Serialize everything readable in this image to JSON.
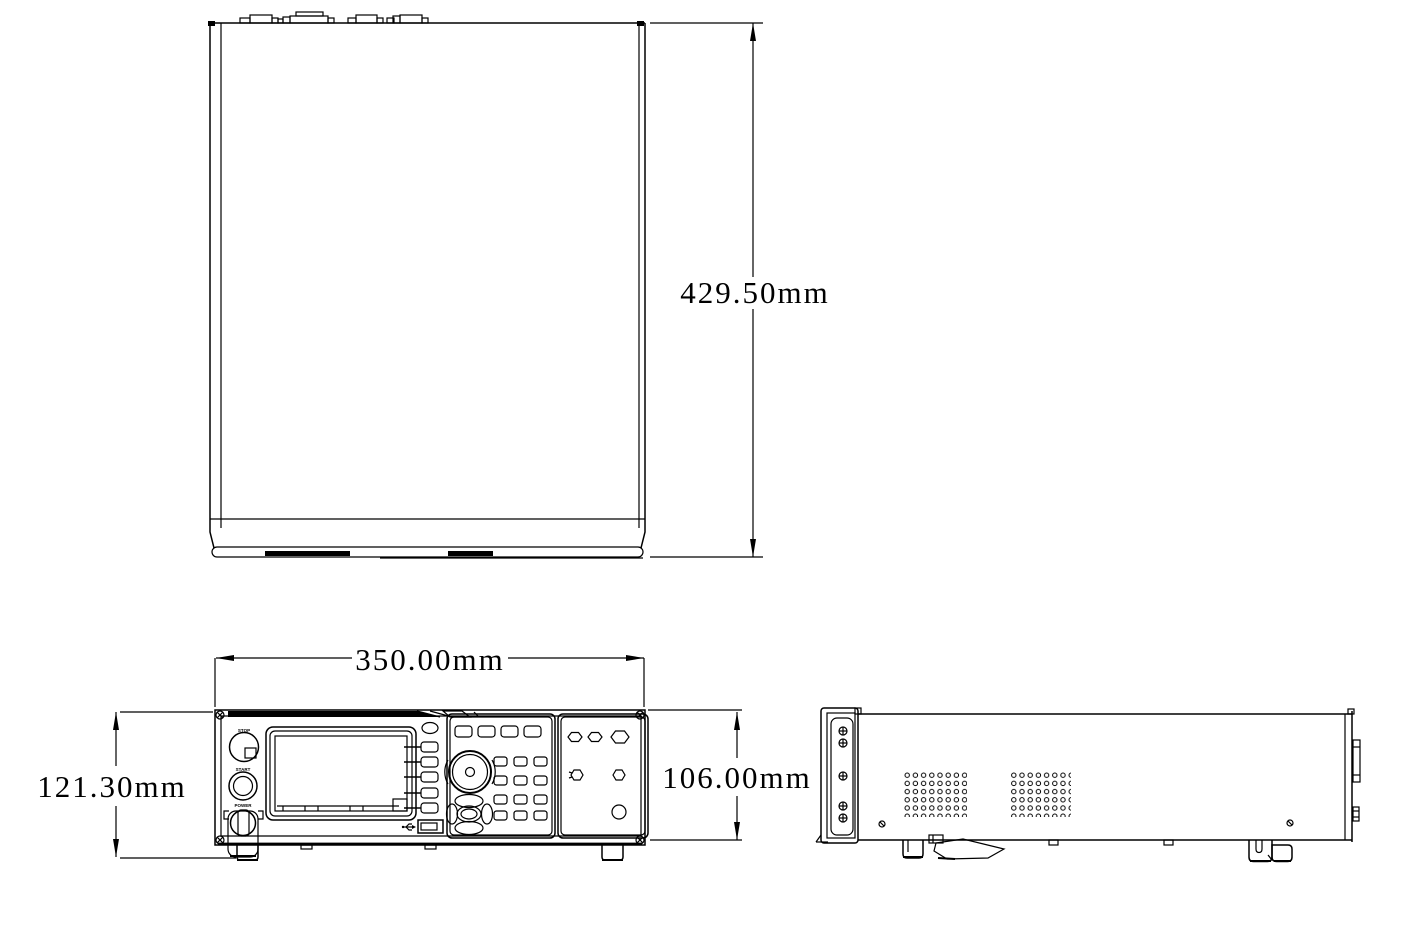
{
  "page": {
    "background": "#ffffff",
    "line_color": "#000000"
  },
  "dims": {
    "depth": "429.50mm",
    "width": "350.00mm",
    "overall_height": "121.30mm",
    "chassis_height": "106.00mm"
  },
  "front_panel": {
    "stop": "STOP",
    "start": "START",
    "power": "POWER"
  }
}
